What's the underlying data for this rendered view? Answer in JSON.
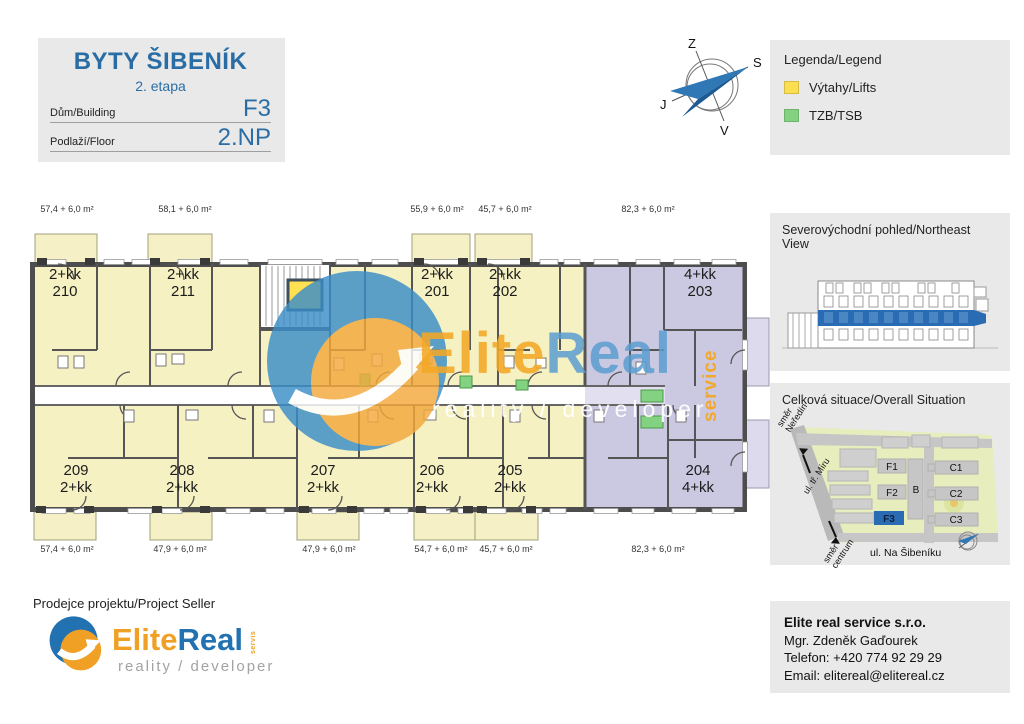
{
  "title_block": {
    "title": "BYTY ŠIBENÍK",
    "subtitle": "2. etapa",
    "building_label": "Dům/Building",
    "building_value": "F3",
    "floor_label": "Podlaží/Floor",
    "floor_value": "2.NP"
  },
  "compass": {
    "top": "Z",
    "right": "S",
    "left": "J",
    "bottom": "V"
  },
  "legend": {
    "title": "Legenda/Legend",
    "items": [
      {
        "label": "Výtahy/Lifts",
        "color": "#fbdf51"
      },
      {
        "label": "TZB/TSB",
        "color": "#82d282"
      }
    ]
  },
  "plan": {
    "apartments_top": [
      {
        "type": "2+kk",
        "num": "210"
      },
      {
        "type": "2+kk",
        "num": "211"
      },
      {
        "type": "2+kk",
        "num": "201"
      },
      {
        "type": "2+kk",
        "num": "202"
      },
      {
        "type": "4+kk",
        "num": "203"
      }
    ],
    "apartments_bottom": [
      {
        "num": "209",
        "type": "2+kk"
      },
      {
        "num": "208",
        "type": "2+kk"
      },
      {
        "num": "207",
        "type": "2+kk"
      },
      {
        "num": "206",
        "type": "2+kk"
      },
      {
        "num": "205",
        "type": "2+kk"
      },
      {
        "num": "204",
        "type": "4+kk"
      }
    ],
    "areas_top": [
      "57,4 + 6,0 m²",
      "58,1 + 6,0 m²",
      "55,9 + 6,0 m²",
      "45,7 + 6,0 m²",
      "82,3 + 6,0 m²"
    ],
    "areas_bottom": [
      "57,4 + 6,0 m²",
      "47,9 + 6,0 m²",
      "47,9 + 6,0 m²",
      "54,7 + 6,0 m²",
      "45,7 + 6,0 m²",
      "82,3 + 6,0 m²"
    ]
  },
  "watermark": {
    "elite": "Elite",
    "real": "Real",
    "tagline": "reality / developer",
    "vertical": "service"
  },
  "ne_view": {
    "title": "Severovýchodní pohled/Northeast View"
  },
  "situation": {
    "title": "Celková situace/Overall Situation",
    "buildings": {
      "f1": "F1",
      "f2": "F2",
      "f3": "F3",
      "b": "B",
      "c1": "C1",
      "c2": "C2",
      "c3": "C3"
    },
    "street_bottom": "ul. Na Šibeníku",
    "street_diag": "ul. tř. Míru",
    "dir_up": {
      "line1": "směr",
      "line2": "Neředín"
    },
    "dir_down": {
      "line1": "směr",
      "line2": "centrum"
    }
  },
  "seller": {
    "label": "Prodejce projektu/Project Seller",
    "brand_elite": "Elite",
    "brand_real": "Real",
    "brand_small": "servis",
    "tagline": "reality / developer"
  },
  "contact": {
    "company": "Elite real service s.r.o.",
    "person": "Mgr. Zdeněk Gaďourek",
    "phone": "Telefon: +420 774 92 29 29",
    "email": "Email: elitereal@elitereal.cz"
  },
  "colors": {
    "accent_blue": "#2a6da4",
    "plan_yellow": "#f6f1c3",
    "plan_purple": "#cbc9e1",
    "wall_gray": "#4d4d4d",
    "lift_yellow": "#fbdf51",
    "tzb_green": "#82d282",
    "logo_orange": "#f0a125",
    "logo_blue": "#2272b2",
    "highlight_blue": "#2a6cb3",
    "panel_gray": "#e9e9e9"
  }
}
